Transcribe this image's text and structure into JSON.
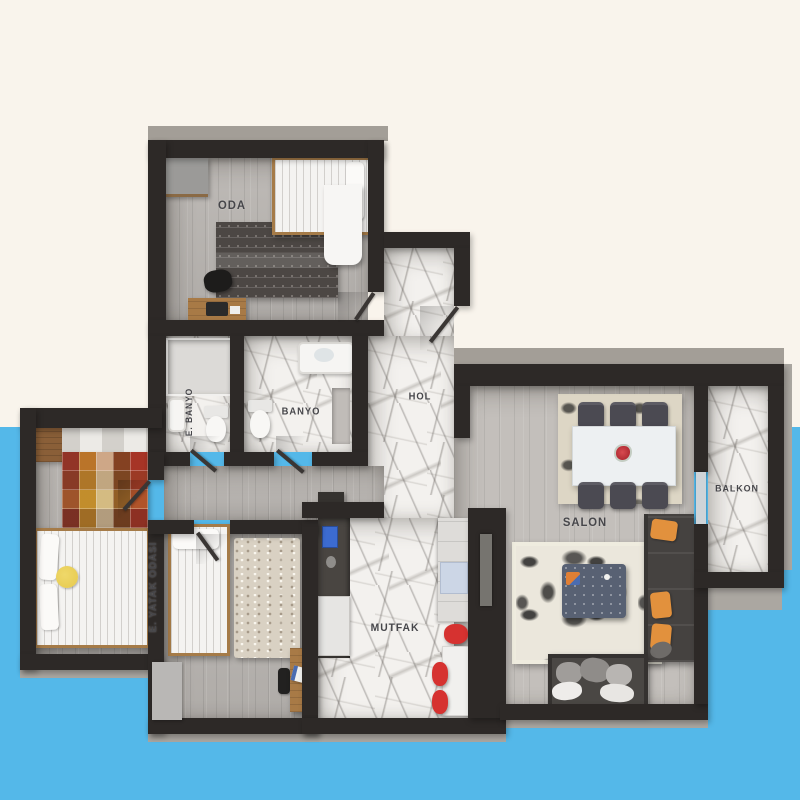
{
  "rooms": {
    "oda": {
      "label": "ODA"
    },
    "hol": {
      "label": "HOL"
    },
    "e_banyo": {
      "label": "E. BANYO"
    },
    "banyo": {
      "label": "BANYO"
    },
    "e_yatak_odasi": {
      "label": "E. YATAK ODASI"
    },
    "mutfak": {
      "label": "MUTFAK"
    },
    "salon": {
      "label": "SALON"
    },
    "balkon": {
      "label": "BALKON"
    }
  },
  "palette": {
    "background_top": "#f9f4ec",
    "background_bottom": "#54b8e9",
    "wall": "#2d2927",
    "wood_floor": "#bab6b2",
    "marble_floor": "#f3f1ee",
    "label_text": "#46464a",
    "accent_orange": "#e2913d",
    "accent_red": "#d63230",
    "accent_yellow": "#e6c94c"
  }
}
